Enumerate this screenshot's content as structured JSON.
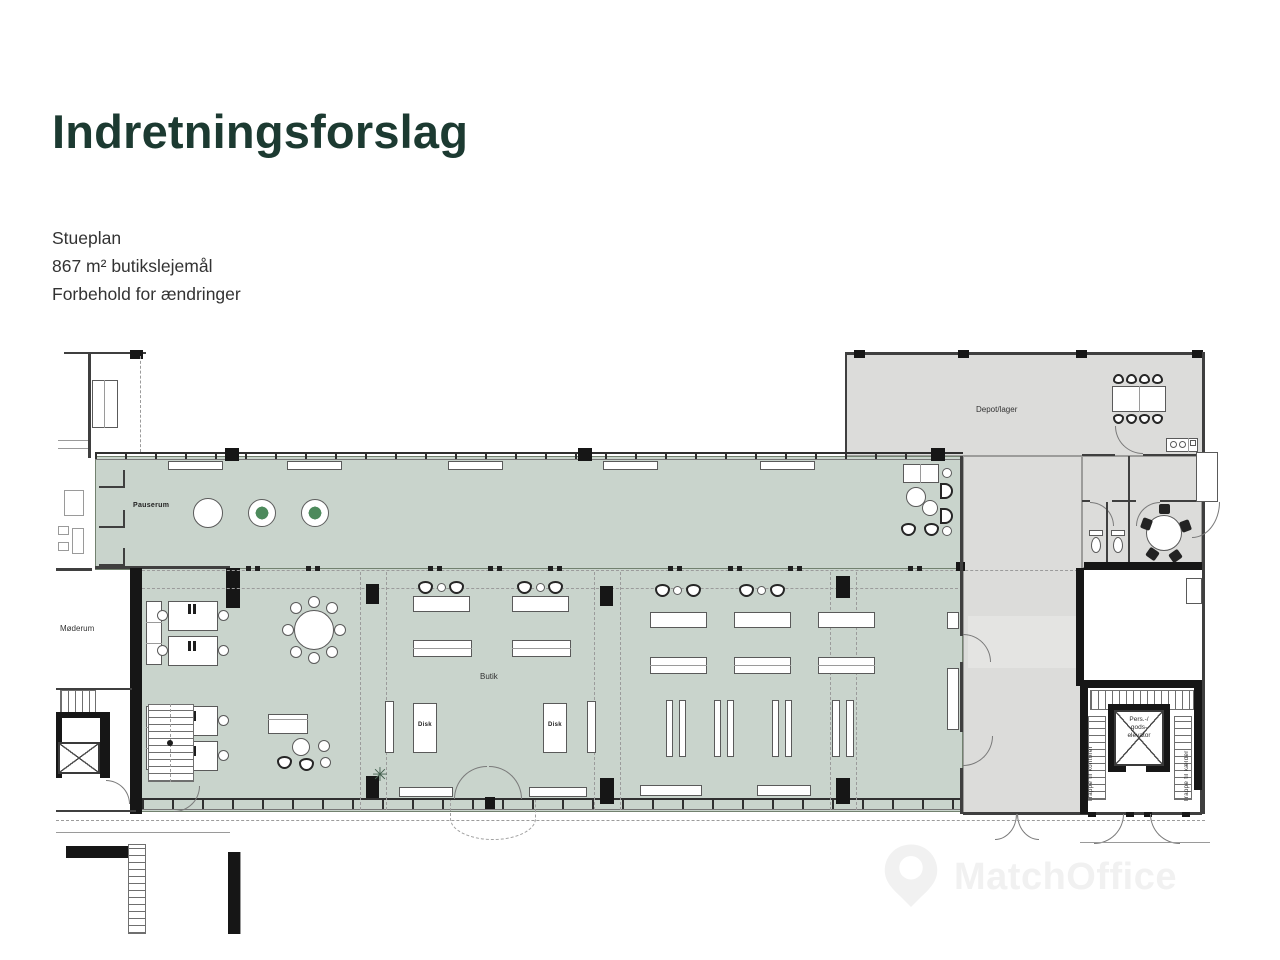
{
  "header": {
    "title": "Indretningsforslag",
    "lines": [
      "Stueplan",
      "867 m² butikslejemål",
      "Forbehold for ændringer"
    ]
  },
  "plan": {
    "rooms": {
      "pauserum": "Pauserum",
      "depot": "Depot/lager",
      "butik": "Butik",
      "moderum": "Møderum"
    },
    "counters": {
      "disk": "Disk"
    },
    "elevator": {
      "line1": "Pers.-/",
      "line2": "gods-",
      "line3": "elevator"
    },
    "stairs": {
      "left": "Trappe til kontorer",
      "right": "Trappe til kælder"
    }
  },
  "watermark": {
    "text": "MatchOffice",
    "icon": "location-pin-icon"
  },
  "colors": {
    "title_green": "#1c3a31",
    "lease_green": "#c9d4cc",
    "common_gray": "#dcdcda",
    "highlight_gray": "#e4e4e2",
    "wall_black": "#161616"
  }
}
